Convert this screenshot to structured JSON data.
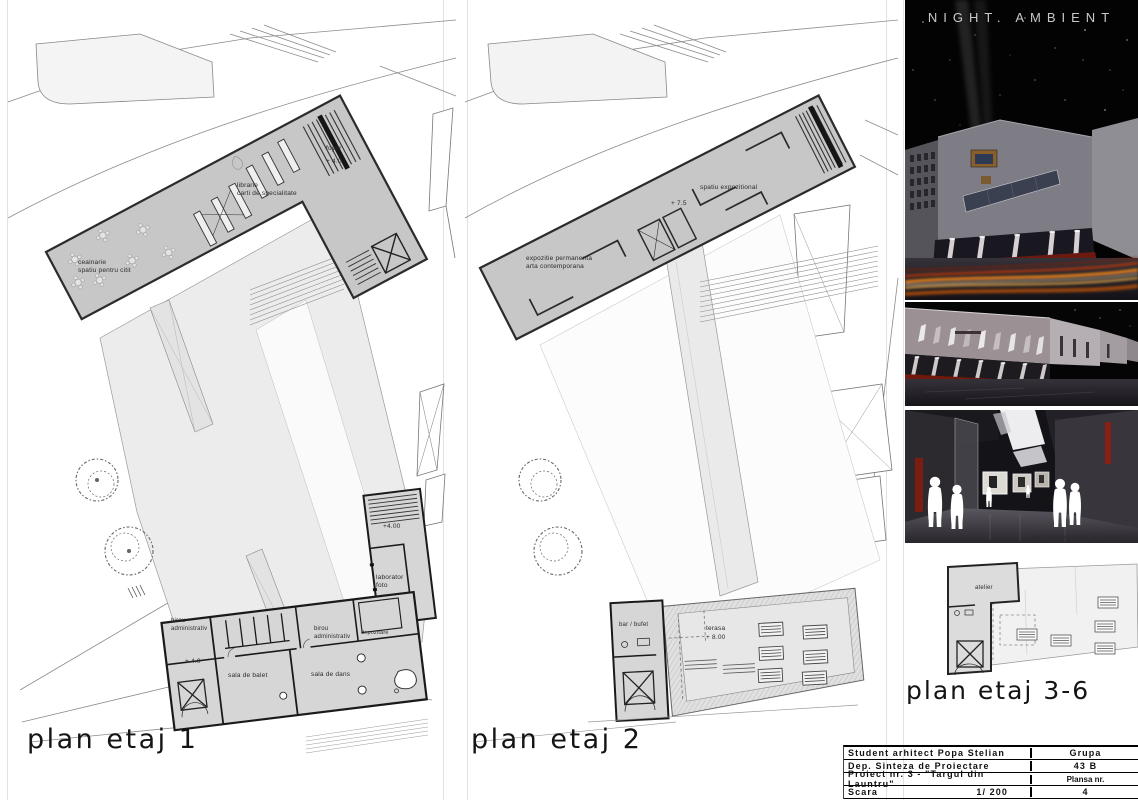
{
  "plan1": {
    "title": "plan etaj 1",
    "labels": {
      "ceainarie1": "ceainarie",
      "ceainarie2": "spatiu pentru citit",
      "librarie1": "librarie",
      "librarie2": "carti de specialitate",
      "foyer": "foyer",
      "foyer_level": "+ 4.0",
      "wing_level": "+4.00",
      "laborator1": "laborator",
      "laborator2": "foto",
      "birou_left1": "birou",
      "birou_left2": "administrativ",
      "birou_mid1": "birou",
      "birou_mid2": "administrativ",
      "depozitare": "depozitare",
      "hall_level": "+ 4.0",
      "sala_balet": "sala de balet",
      "sala_dans": "sala de dans"
    }
  },
  "plan2": {
    "title": "plan etaj 2",
    "labels": {
      "spatiu": "spatiu expozitional",
      "level": "+ 7.5",
      "expozitie1": "expozitie permanenta",
      "expozitie2": "arta contemporana",
      "bar": "bar / bufet",
      "terasa": "terasa",
      "terasa_level": "+ 8.00"
    }
  },
  "plan36": {
    "title": "plan etaj 3-6",
    "labels": {
      "atelier": "atelier"
    }
  },
  "renders": {
    "title": "NIGHT. AMBIENT",
    "interior_caption": "INTERIOR MUZEUL \"N. TONITZA\""
  },
  "titleblock": {
    "rows": [
      {
        "left": "Student arhitect Popa Stelian",
        "right": "Grupa"
      },
      {
        "left": "Dep. Sinteza de Proiectare",
        "right": "43 B"
      },
      {
        "left": "Proiect nr. 3 - \"Targul din Launtru\"",
        "right": "Plansa nr."
      },
      {
        "left": "Scara",
        "mid": "1/ 200",
        "right": "4"
      }
    ]
  },
  "colors": {
    "plan_fill": "#c7c7c7",
    "plaza_fill": "#ececec",
    "accent_red": "#6e1b12",
    "trail_orange": "#ff8c1a",
    "night_sky": "#000000"
  }
}
